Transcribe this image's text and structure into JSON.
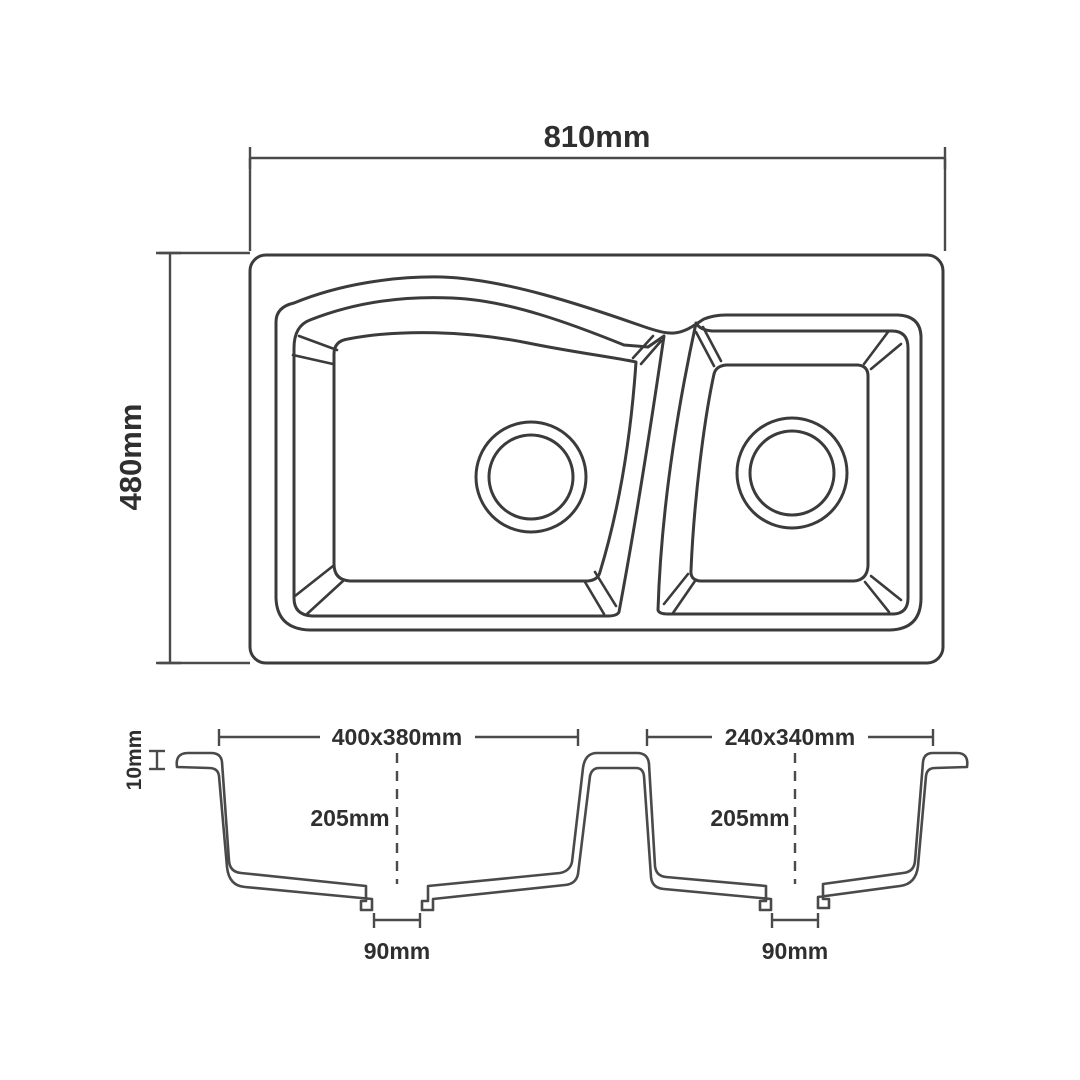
{
  "drawing": {
    "title": "double-bowl-sink-technical-drawing",
    "overall": {
      "width_label": "810mm",
      "height_label": "480mm"
    },
    "rim": {
      "height_label": "10mm"
    },
    "left_bowl": {
      "opening_label": "400x380mm",
      "depth_label": "205mm",
      "drain_label": "90mm"
    },
    "right_bowl": {
      "opening_label": "240x340mm",
      "depth_label": "205mm",
      "drain_label": "90mm"
    },
    "colors": {
      "line": "#3b3b3b",
      "text": "#2f2f2f",
      "background": "#ffffff"
    }
  }
}
